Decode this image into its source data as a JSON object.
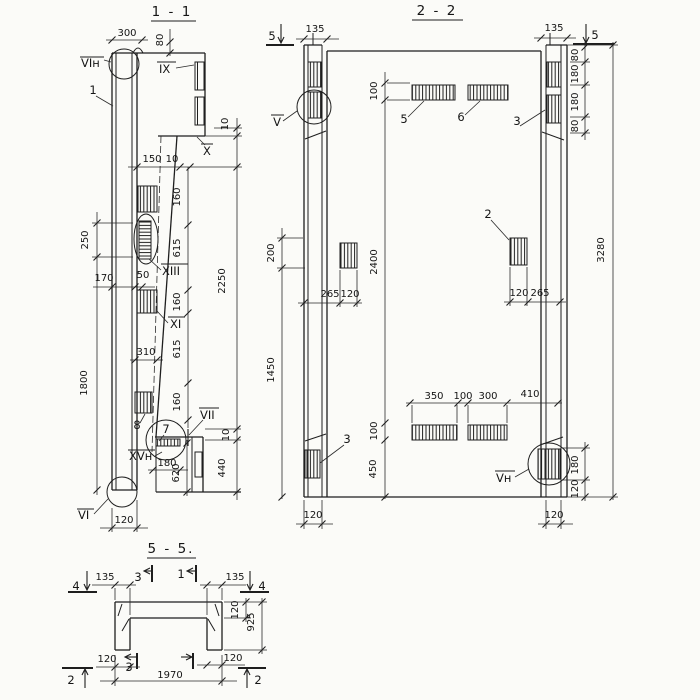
{
  "s1": {
    "title": "1 - 1",
    "labels": {
      "viN": "VIн",
      "one": "1",
      "ix": "IX",
      "x": "X",
      "xiii": "XIII",
      "xi": "XI",
      "seven": "7",
      "eight": "8",
      "vii": "VII",
      "xvN": "XVн",
      "vi": "VI"
    },
    "dims": {
      "d300": "300",
      "d80": "80",
      "d150": "150",
      "d10a": "10",
      "d10b": "10",
      "d160a": "160",
      "d615a": "615",
      "d160b": "160",
      "d615b": "615",
      "d160c": "160",
      "d2250": "2250",
      "d250": "250",
      "d170": "170",
      "d50": "50",
      "d1800": "1800",
      "d310": "310",
      "d10c": "10",
      "d440": "440",
      "d620": "620",
      "d180": "180",
      "d120": "120"
    }
  },
  "s2": {
    "title": "2 - 2",
    "labels": {
      "cut5L": "5",
      "cut5R": "5",
      "v": "V",
      "vN": "Vн",
      "two": "2",
      "threeL": "3",
      "threeR": "3",
      "five": "5",
      "six": "6"
    },
    "dims": {
      "d135L": "135",
      "d135R": "135",
      "d80a": "80",
      "d180a": "180",
      "d180b": "180",
      "d80b": "80",
      "d100t": "100",
      "d200": "200",
      "d2400": "2400",
      "d1450": "1450",
      "d265L": "265",
      "d120L": "120",
      "d120R": "120",
      "d265R": "265",
      "d3280": "3280",
      "d350": "350",
      "d100m": "100",
      "d300": "300",
      "d410": "410",
      "d100b": "100",
      "d450": "450",
      "d180r": "180",
      "d120r": "120",
      "d120bL": "120",
      "d120bR": "120"
    }
  },
  "s5": {
    "title": "5 - 5.",
    "labels": {
      "cut4L": "4",
      "cut4R": "4",
      "cut3t": "3",
      "cut1t": "1",
      "cut3b": "3",
      "cut2L": "2",
      "cut2R": "2"
    },
    "dims": {
      "d135L": "135",
      "d135R": "135",
      "d120s": "120",
      "d925": "925",
      "d120L": "120",
      "d120R": "120",
      "d1970": "1970"
    }
  }
}
